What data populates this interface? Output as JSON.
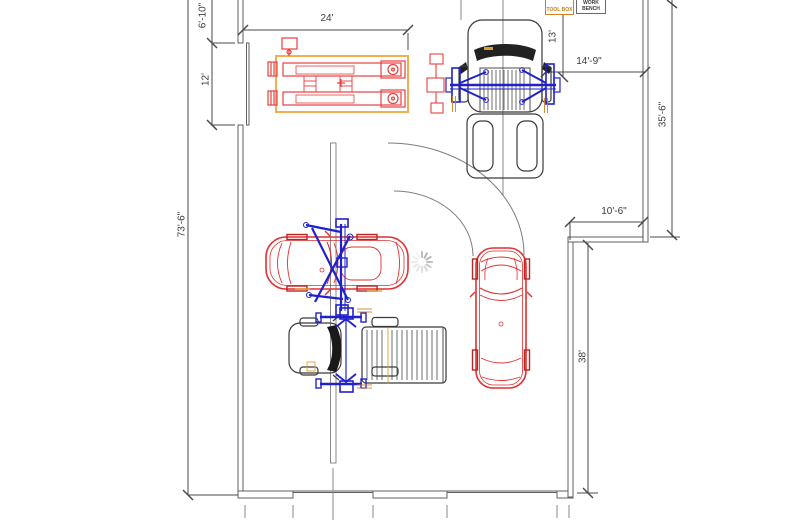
{
  "plan": {
    "dims": {
      "d24": "24'",
      "d6_10": "6'-10\"",
      "d12": "12'",
      "d73_6": "73'-6\"",
      "d13": "13'",
      "d14_9": "14'-9\"",
      "d35_6": "35'-6\"",
      "d10_6": "10'-6\"",
      "d38": "38'"
    },
    "labels": {
      "toolbox": "TOOL BOX",
      "workbench": "WORK BENCH"
    },
    "colors": {
      "car_red": "#e03030",
      "lift_blue": "#2121cc",
      "lift_platform_yellow": "#f0b050",
      "annotation_orange": "#d08020",
      "wall_gray": "#5f5f5f",
      "spinner_gray": "#b5b5b5"
    }
  }
}
